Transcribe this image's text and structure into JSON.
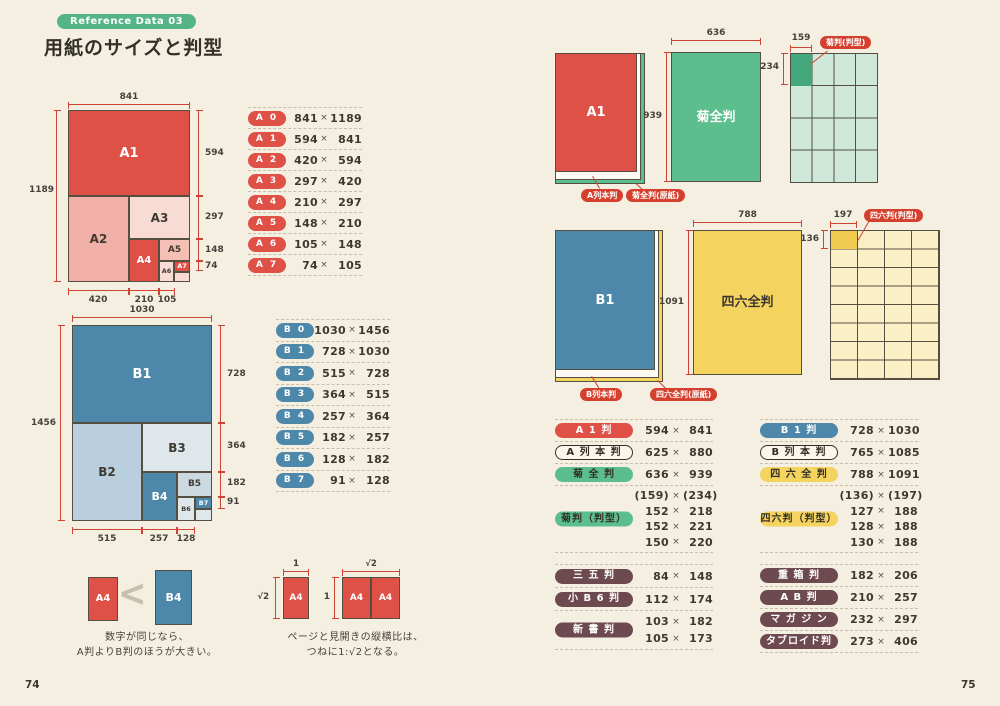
{
  "header": {
    "badge": "Reference Data 03",
    "title": "用紙のサイズと判型"
  },
  "footer": {
    "page_left": "74",
    "page_right": "75"
  },
  "times": "×",
  "colors": {
    "background": "#f5efe2",
    "accent_red": "#df5047",
    "accent_blue": "#4d87a9",
    "accent_green": "#5cbd8d",
    "accent_yellow": "#f4d35e",
    "pill_brown": "#6d4a50",
    "dimension_red": "#cc4434",
    "badge_green": "#55b487"
  },
  "a_diagram": {
    "top": "841",
    "left": "1189",
    "cells": [
      "A1",
      "A2",
      "A3",
      "A4",
      "A5",
      "A6",
      "A7"
    ],
    "right": [
      "594",
      "297",
      "148",
      "74"
    ],
    "bottom": [
      "420",
      "210",
      "105"
    ]
  },
  "a_table": {
    "rows": [
      {
        "label": "A 0",
        "w": "841",
        "h": "1189"
      },
      {
        "label": "A 1",
        "w": "594",
        "h": "841"
      },
      {
        "label": "A 2",
        "w": "420",
        "h": "594"
      },
      {
        "label": "A 3",
        "w": "297",
        "h": "420"
      },
      {
        "label": "A 4",
        "w": "210",
        "h": "297"
      },
      {
        "label": "A 5",
        "w": "148",
        "h": "210"
      },
      {
        "label": "A 6",
        "w": "105",
        "h": "148"
      },
      {
        "label": "A 7",
        "w": "74",
        "h": "105"
      }
    ]
  },
  "b_diagram": {
    "top": "1030",
    "left": "1456",
    "cells": [
      "B1",
      "B2",
      "B3",
      "B4",
      "B5",
      "B6",
      "B7"
    ],
    "right": [
      "728",
      "364",
      "182",
      "91"
    ],
    "bottom": [
      "515",
      "257",
      "128"
    ]
  },
  "b_table": {
    "rows": [
      {
        "label": "B 0",
        "w": "1030",
        "h": "1456"
      },
      {
        "label": "B 1",
        "w": "728",
        "h": "1030"
      },
      {
        "label": "B 2",
        "w": "515",
        "h": "728"
      },
      {
        "label": "B 3",
        "w": "364",
        "h": "515"
      },
      {
        "label": "B 4",
        "w": "257",
        "h": "364"
      },
      {
        "label": "B 5",
        "w": "182",
        "h": "257"
      },
      {
        "label": "B 6",
        "w": "128",
        "h": "182"
      },
      {
        "label": "B 7",
        "w": "91",
        "h": "128"
      }
    ]
  },
  "compare": {
    "small": "A4",
    "symbol": "<",
    "large": "B4",
    "caption1": "数字が同じなら、",
    "caption2": "A判よりB判のほうが大きい。"
  },
  "ratio": {
    "single_top": "1",
    "single_side": "√2",
    "single_label": "A4",
    "spread_top": "√2",
    "spread_side": "1",
    "spread_labels": [
      "A4",
      "A4"
    ],
    "caption1": "ページと見開きの縦横比は、",
    "caption2": "つねに1:√2となる。"
  },
  "kiku_fig": {
    "sheet": "A1",
    "callout_sheet": "A列本判",
    "callout_genshi": "菊全判(原紙)",
    "zenhan": "菊全判",
    "zenhan_w": "636",
    "zenhan_h": "939",
    "grid_callout": "菊判(判型)",
    "cell_w": "159",
    "cell_h": "234"
  },
  "shiroku_fig": {
    "sheet": "B1",
    "callout_sheet": "B列本判",
    "callout_genshi": "四六全判(原紙)",
    "zenhan": "四六全判",
    "zenhan_w": "788",
    "zenhan_h": "1091",
    "grid_callout": "四六判(判型)",
    "cell_w": "197",
    "cell_h": "136"
  },
  "kiku_table": {
    "rows": [
      {
        "label": "A 1 判",
        "w": "594",
        "h": "841"
      },
      {
        "label": "A 列 本 判",
        "w": "625",
        "h": "880"
      },
      {
        "label": "菊 全 判",
        "w": "636",
        "h": "939"
      }
    ],
    "group_label": "菊判（判型）",
    "group": [
      {
        "w": "(159)",
        "h": "(234)"
      },
      {
        "w": "152",
        "h": "218"
      },
      {
        "w": "152",
        "h": "221"
      },
      {
        "w": "150",
        "h": "220"
      }
    ]
  },
  "shiroku_table": {
    "rows": [
      {
        "label": "B 1 判",
        "w": "728",
        "h": "1030"
      },
      {
        "label": "B 列 本 判",
        "w": "765",
        "h": "1085"
      },
      {
        "label": "四 六 全 判",
        "w": "788",
        "h": "1091"
      }
    ],
    "group_label": "四六判（判型）",
    "group": [
      {
        "w": "(136)",
        "h": "(197)"
      },
      {
        "w": "127",
        "h": "188"
      },
      {
        "w": "128",
        "h": "188"
      },
      {
        "w": "130",
        "h": "188"
      }
    ]
  },
  "misc_left": {
    "rows": [
      {
        "label": "三 五 判",
        "w": "84",
        "h": "148"
      },
      {
        "label": "小 B 6 判",
        "w": "112",
        "h": "174"
      }
    ],
    "group_label": "新 書 判",
    "group": [
      {
        "w": "103",
        "h": "182"
      },
      {
        "w": "105",
        "h": "173"
      }
    ]
  },
  "misc_right": {
    "rows": [
      {
        "label": "重 箱 判",
        "w": "182",
        "h": "206"
      },
      {
        "label": "A B 判",
        "w": "210",
        "h": "257"
      },
      {
        "label": "マ ガ ジ ン",
        "w": "232",
        "h": "297"
      },
      {
        "label": "タブロイド判",
        "w": "273",
        "h": "406"
      }
    ]
  }
}
